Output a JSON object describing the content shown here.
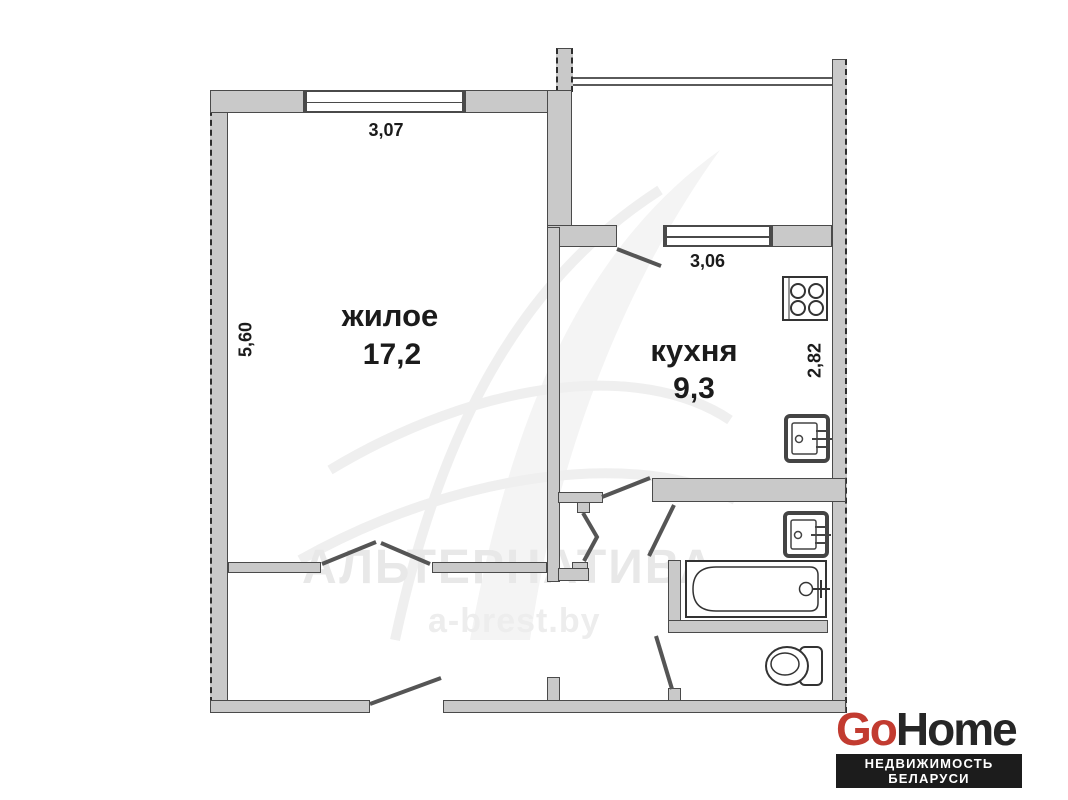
{
  "meta": {
    "type": "apartment floor plan",
    "language": "ru"
  },
  "rooms": {
    "living": {
      "label": "жилое",
      "area": "17,2"
    },
    "kitchen": {
      "label": "кухня",
      "area": "9,3"
    }
  },
  "dimensions": {
    "living_width": "3,07",
    "living_depth": "5,60",
    "kitchen_window": "3,06",
    "kitchen_depth": "2,82"
  },
  "fixtures": [
    "stove",
    "kitchen-sink",
    "bathroom-sink",
    "bathtub",
    "toilet"
  ],
  "watermark": {
    "title": "АЛЬТЕРНАТИВА",
    "site": "a-brest.by"
  },
  "logo": {
    "brand_red": "Go",
    "brand_dark": "Home",
    "tagline": "НЕДВИЖИМОСТЬ БЕЛАРУСИ",
    "red": "#c23b30",
    "dark": "#262626"
  },
  "colors": {
    "wall_fill": "#c9c9c9",
    "wall_stroke": "#4a4a4a",
    "text": "#1b1b1b",
    "watermark": "#e8e8e8"
  }
}
